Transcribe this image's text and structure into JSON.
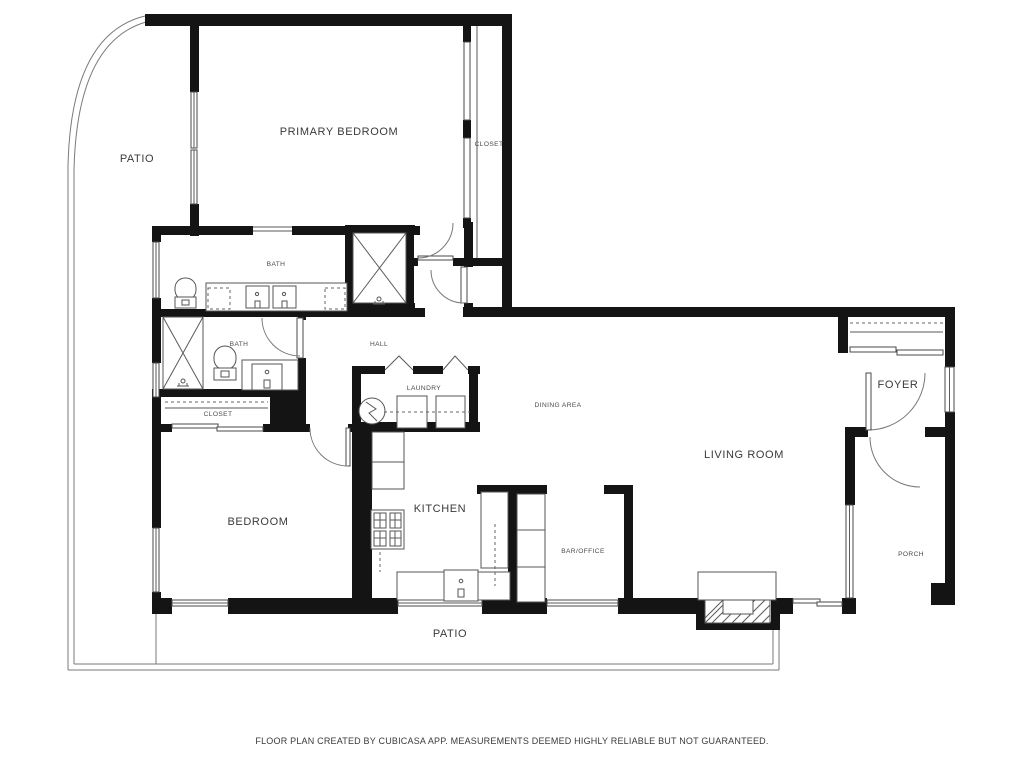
{
  "document": {
    "type": "floor-plan",
    "footer_text": "FLOOR PLAN CREATED BY CUBICASA APP. MEASUREMENTS DEEMED HIGHLY RELIABLE BUT NOT GUARANTEED."
  },
  "colors": {
    "wall": "#141414",
    "line": "#5a5a5a",
    "label": "#3a3a3a",
    "background": "#ffffff"
  },
  "rooms": {
    "patio_top": {
      "label": "PATIO"
    },
    "primary_bedroom": {
      "label": "PRIMARY BEDROOM"
    },
    "closet_primary": {
      "label": "CLOSET"
    },
    "bath_primary": {
      "label": "BATH"
    },
    "bath_hall": {
      "label": "BATH"
    },
    "hall": {
      "label": "HALL"
    },
    "laundry": {
      "label": "LAUNDRY"
    },
    "closet_hall": {
      "label": "CLOSET"
    },
    "dining": {
      "label": "DINING AREA"
    },
    "foyer": {
      "label": "FOYER"
    },
    "living": {
      "label": "LIVING ROOM"
    },
    "bedroom": {
      "label": "BEDROOM"
    },
    "kitchen": {
      "label": "KITCHEN"
    },
    "bar_office": {
      "label": "BAR/OFFICE"
    },
    "porch": {
      "label": "PORCH"
    },
    "patio_bottom": {
      "label": "PATIO"
    }
  }
}
